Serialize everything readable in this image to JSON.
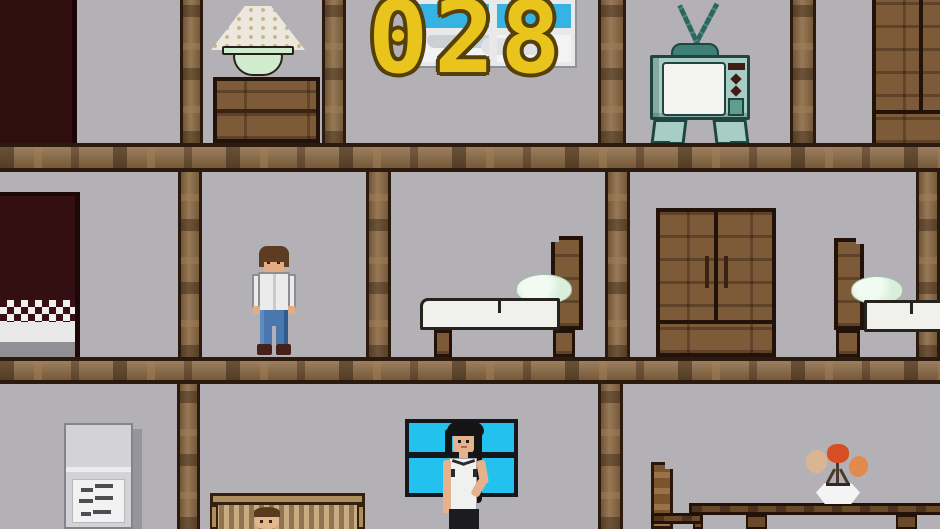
{
  "hud": {
    "score": "028",
    "score_color": "#e8c41c",
    "score_outline_color": "#55400a"
  },
  "palette": {
    "wall": "#b3b1b6",
    "beam_wood": "#8c6a44",
    "furniture_wood": "#7d5b38",
    "dark_doorway": "#300e0e",
    "blanket_maroon": "#3a1014",
    "tv_teal_light": "#a9cdc5",
    "tv_teal_dark": "#1e453f",
    "tv_knob_maroon": "#401c14",
    "window_sky": "#35b4e4",
    "window_cyan": "#22c1ee",
    "window_frame_dark": "#14181c",
    "mattress_white": "#f0f0ec",
    "pillow_mint": "#d9efdb",
    "lamp_shade": "#ece8de",
    "lamp_base_mint": "#cfeccf",
    "fridge_gray": "#d3d3d7",
    "note_white": "#f2f2f2",
    "crib_tan": "#ae8e5e",
    "skin": "#e2ac84",
    "hair_brown": "#5e3c22",
    "hair_black": "#141414",
    "jeans_blue": "#4a78ae",
    "flower_red": "#d84e24",
    "flower_orange": "#e28a4c",
    "flower_tan": "#d9b593"
  },
  "scene": {
    "floors": [
      {
        "name": "top-floor",
        "items": [
          "dark-doorway",
          "table-lamp",
          "dresser",
          "cloud-window",
          "score-counter",
          "television",
          "wardrobe"
        ]
      },
      {
        "name": "middle-floor",
        "items": [
          "bed-dark-blanket",
          "standing-man",
          "bed-with-pillow",
          "wardrobe",
          "bed-with-pillow"
        ]
      },
      {
        "name": "bottom-floor",
        "items": [
          "refrigerator",
          "note-on-fridge",
          "crib-with-baby",
          "blue-window",
          "standing-woman",
          "chair",
          "dining-table",
          "vase-of-flowers"
        ]
      }
    ]
  }
}
